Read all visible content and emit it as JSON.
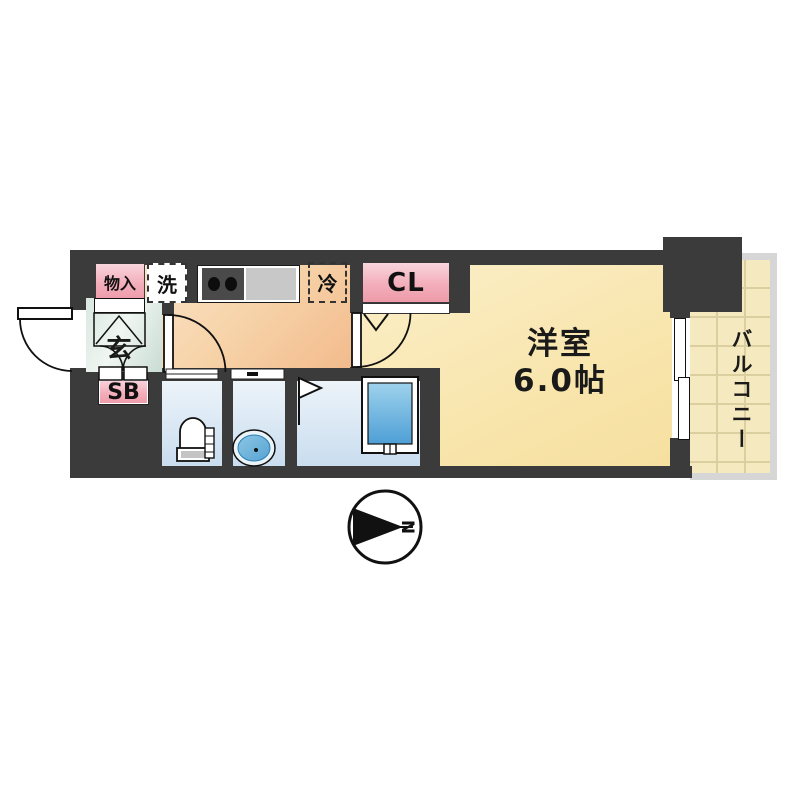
{
  "plan": {
    "title_hint": "1K apartment floor plan",
    "rooms": {
      "living": {
        "label": "洋室",
        "area": "6.0帖"
      },
      "balcony": {
        "label": "バルコニー"
      },
      "entrance": {
        "label": "玄"
      }
    },
    "labels": {
      "storage": "物入",
      "washer": "洗",
      "fridge": "冷",
      "closet": "CL",
      "shoe_box": "SB"
    },
    "compass": {
      "direction": "N"
    },
    "colors": {
      "wall": "#3B3B3B",
      "living_floor": "#F8E4A9",
      "kitchen_floor": "#F5CA9E",
      "entrance_floor": "#D5E4DD",
      "wet_area_floor": "#C9DDEF",
      "balcony_floor": "#F5EABF",
      "label_pink": "#F0A3B1",
      "bathtub_blue": "#5FA8D8"
    }
  }
}
